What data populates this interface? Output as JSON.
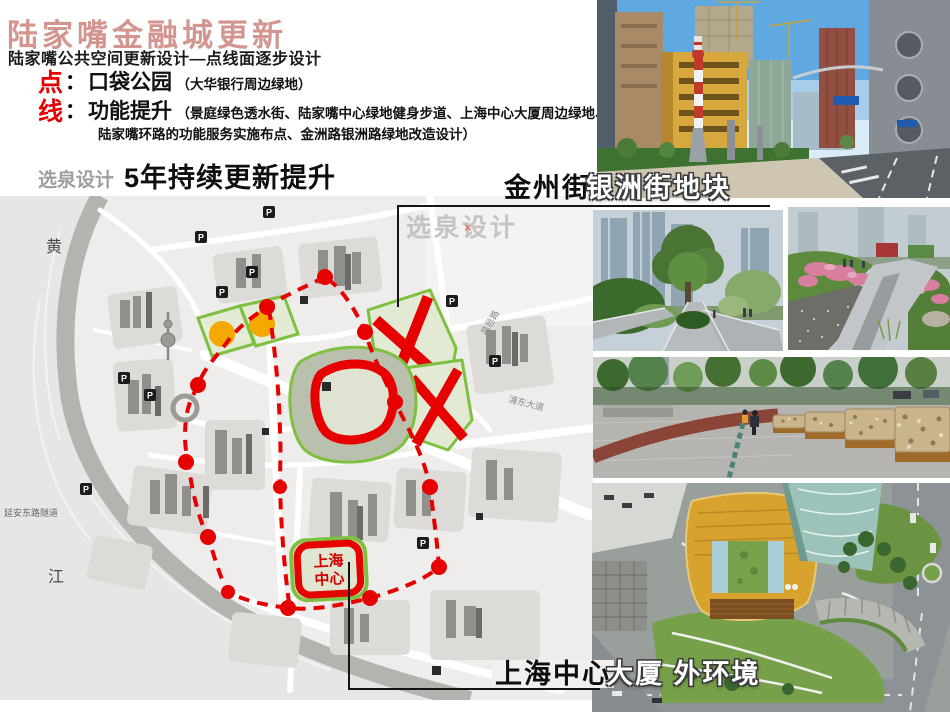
{
  "header": {
    "title": "陆家嘴金融城更新",
    "subtitle": "陆家嘴公共空间更新设计—点线面逐步设计"
  },
  "bullets": [
    {
      "marker": "点",
      "colon": "：",
      "heading": "口袋公园",
      "detail": "（大华银行周边绿地）"
    },
    {
      "marker": "线",
      "colon": "：",
      "heading": "功能提升",
      "detail_line1": "（景庭绿色透水街、陆家嘴中心绿地健身步道、上海中心大厦周边绿地、",
      "detail_line2": "陆家嘴环路的功能服务实施布点、金洲路银洲路绿地改造设计）"
    }
  ],
  "tagline": {
    "brand": "选泉设计",
    "text": "5年持续更新提升"
  },
  "map": {
    "watermark": "选泉设计",
    "watermark_x": "×",
    "p_label": "P",
    "labels": {
      "river_char_1": "黄",
      "river_char_2": "江",
      "tunnel": "延安东路隧道",
      "road_pudong": "浦东大道",
      "road_changyi": "昌邑路",
      "center_line1": "上海",
      "center_line2": "中心"
    }
  },
  "callouts": {
    "top": {
      "black": "金州街",
      "white": "银洲街地块"
    },
    "bottom": {
      "black": "上海中心",
      "white": "大厦 外环境"
    }
  },
  "photos": [
    {
      "name": "jinzhou-street-photo",
      "alt": "银洲街街景：道路、红白条纹雕塑柱、在建高楼"
    },
    {
      "name": "park-walkway-photo",
      "alt": "陆家嘴绿地步道与乔木"
    },
    {
      "name": "garden-path-photo",
      "alt": "花境步道与杜鹃花"
    },
    {
      "name": "gabion-bench-photo",
      "alt": "石笼坐凳广场"
    },
    {
      "name": "shanghai-tower-aerial-photo",
      "alt": "上海中心大厦裙房外环境鸟瞰"
    }
  ],
  "colors": {
    "accent_red": "#e60000",
    "title_red": "#d29590",
    "orange": "#f5a800",
    "green_outline": "#7fc041"
  }
}
